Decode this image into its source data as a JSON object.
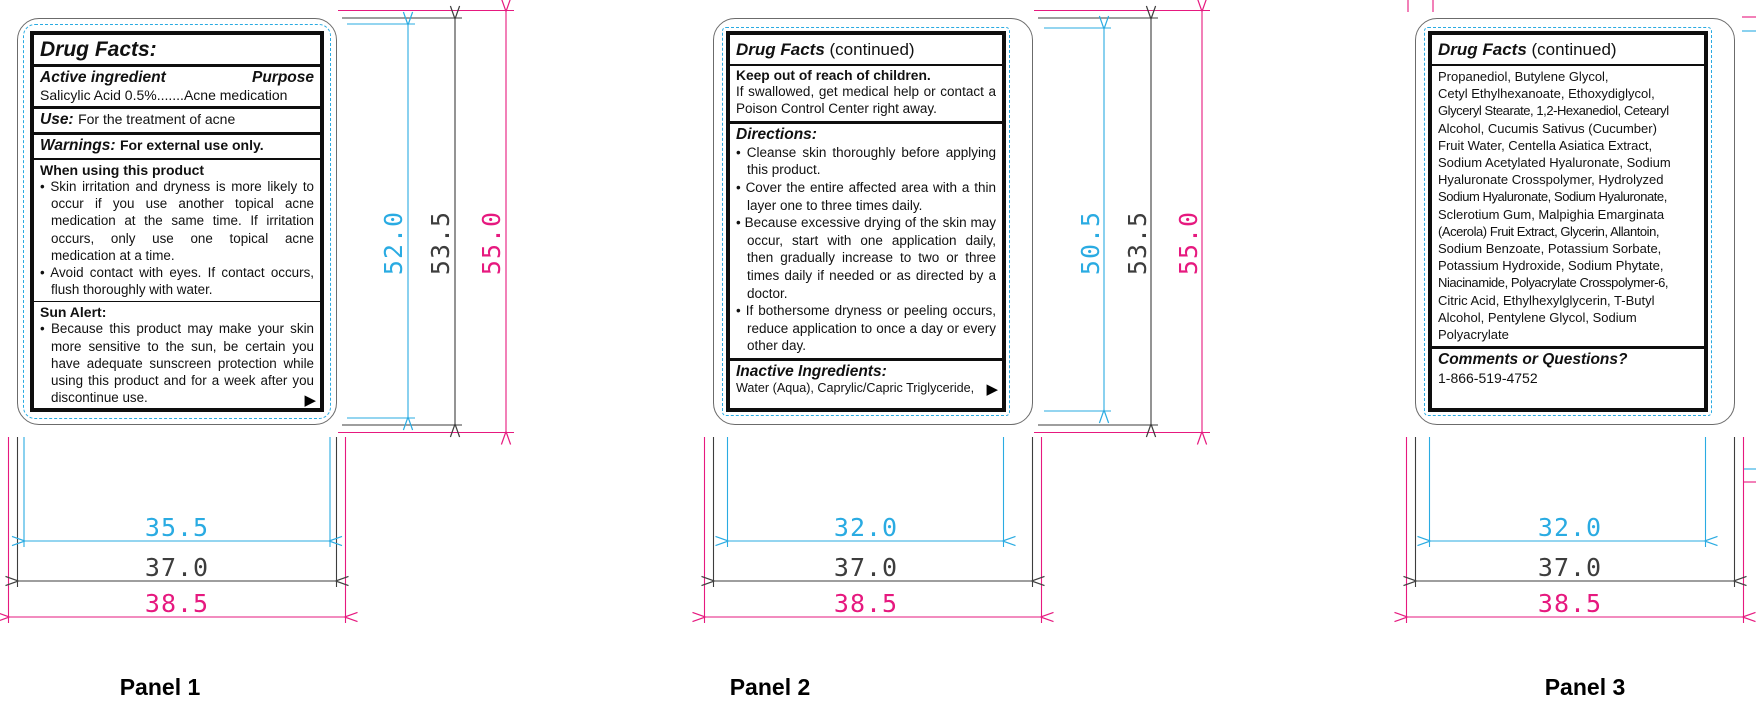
{
  "glyphs": {
    "bullet": "•",
    "continue_arrow": "▶"
  },
  "colors": {
    "safe_area": "#2AABE2",
    "die_line": "#3D3D3D",
    "bleed_line": "#E6197F",
    "label_ink": "#111111"
  },
  "panels": [
    {
      "caption": "Panel 1",
      "dims": {
        "v_safe": "52.0",
        "v_die": "53.5",
        "v_bleed": "55.0",
        "h_safe": "35.5",
        "h_die": "37.0",
        "h_bleed": "38.5"
      },
      "label": {
        "title": "Drug Facts:",
        "active_ingredient_header": "Active ingredient",
        "purpose_header": "Purpose",
        "active_ingredient_line": "Salicylic Acid 0.5%.......Acne medication",
        "use_label": "Use:",
        "use_text": "For the treatment of acne",
        "warnings_label": "Warnings:",
        "warnings_text": "For external use only.",
        "when_using_header": "When using this product",
        "when_using_bullets": [
          "Skin irritation and dryness is more likely to occur if you use another topical acne medication at the same time. If irritation occurs, only use one topical acne medication at a time.",
          "Avoid contact with eyes. If contact occurs, flush thoroughly with water."
        ],
        "sun_alert_header": "Sun Alert:",
        "sun_alert_bullets": [
          "Because this product may make your skin more sensitive to the sun, be certain you have adequate sunscreen protection while using this product and for a week after you discontinue use."
        ]
      }
    },
    {
      "caption": "Panel 2",
      "dims": {
        "v_safe": "50.5",
        "v_die": "53.5",
        "v_bleed": "55.0",
        "h_safe": "32.0",
        "h_die": "37.0",
        "h_bleed": "38.5"
      },
      "label": {
        "title_main": "Drug Facts",
        "title_suffix": " (continued)",
        "keep_header": "Keep out of reach of children.",
        "keep_text": "If swallowed, get medical help or contact a Poison Control Center right away.",
        "directions_header": "Directions:",
        "directions_bullets": [
          "Cleanse skin thoroughly before applying this product.",
          "Cover the entire affected area with a thin layer one to three times daily.",
          "Because excessive drying of the skin may occur, start with one application daily, then gradually increase to two or three times daily if needed or as directed by a doctor.",
          "If bothersome dryness or peeling occurs, reduce application to once a day or every other day."
        ],
        "inactive_header": "Inactive Ingredients:",
        "inactive_text": "Water (Aqua), Caprylic/Capric Triglyceride,"
      }
    },
    {
      "caption": "Panel 3",
      "dims": {
        "h_safe": "32.0",
        "h_die": "37.0",
        "h_bleed": "38.5"
      },
      "label": {
        "title_main": "Drug Facts",
        "title_suffix": " (continued)",
        "ingredients": [
          "Propanediol, Butylene Glycol,",
          "Cetyl Ethylhexanoate, Ethoxydiglycol,",
          "Glyceryl Stearate, 1,2-Hexanediol, Cetearyl",
          "Alcohol, Cucumis Sativus (Cucumber)",
          "Fruit Water, Centella Asiatica Extract,",
          "Sodium Acetylated Hyaluronate, Sodium",
          "Hyaluronate Crosspolymer, Hydrolyzed",
          "Sodium Hyaluronate, Sodium Hyaluronate,",
          "Sclerotium Gum, Malpighia Emarginata",
          "(Acerola) Fruit Extract, Glycerin, Allantoin,",
          "Sodium Benzoate, Potassium Sorbate,",
          "Potassium Hydroxide, Sodium Phytate,",
          "Niacinamide, Polyacrylate Crosspolymer-6,",
          "Citric Acid, Ethylhexylglycerin, T-Butyl",
          "Alcohol, Pentylene Glycol, Sodium",
          "Polyacrylate"
        ],
        "comments_header": "Comments or Questions?",
        "comments_phone": "1-866-519-4752"
      }
    }
  ]
}
